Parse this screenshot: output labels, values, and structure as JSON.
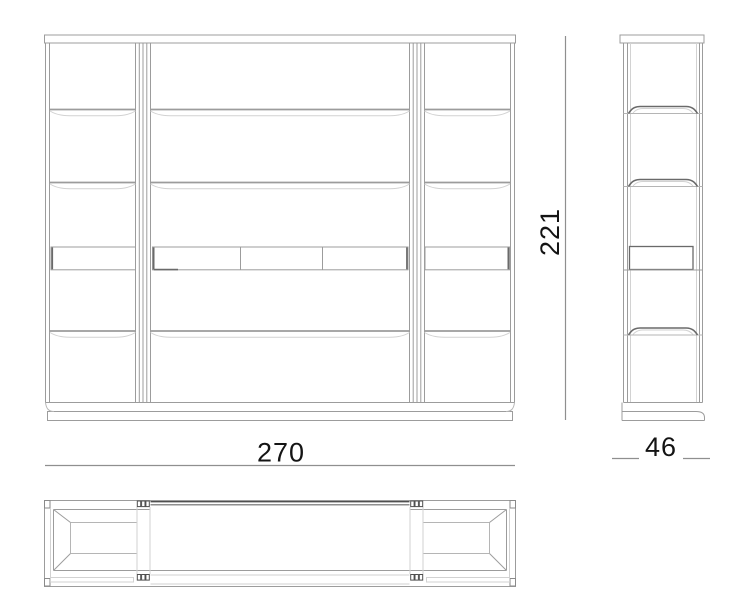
{
  "dimensions": {
    "width_label": "270",
    "height_label": "221",
    "depth_label": "46"
  },
  "colors": {
    "background": "#ffffff",
    "line_light": "#d2d2d2",
    "line_medium": "#9c9c9c",
    "line_dark": "#6a6a6a",
    "line_darkest": "#4f4f4f",
    "text": "#141414"
  }
}
